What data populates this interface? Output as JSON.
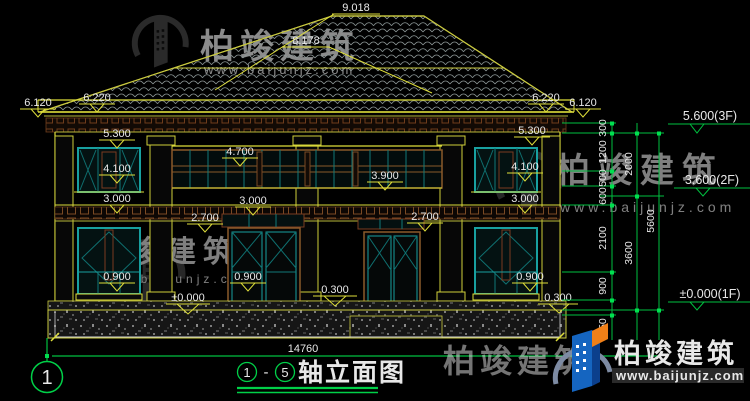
{
  "drawing": {
    "title_axis_start": "1",
    "title_axis_end": "5",
    "title_dash": "-",
    "title_text": "轴立面图",
    "axis_bubble_label": "1",
    "overall_dim": "14760"
  },
  "levels": {
    "ridge": "9.018",
    "sub_ridge": "8.178",
    "left_eave_outer": "6.120",
    "left_eave": "6.220",
    "left_53": "5.300",
    "left_41": "4.100",
    "left_30": "3.000",
    "left_09": "0.900",
    "right_eave": "6.220",
    "right_eave_outer": "6.120",
    "right_53": "5.300",
    "right_41": "4.100",
    "right_30": "3.000",
    "right_09": "0.900",
    "right_03": "0.300",
    "center_47": "4.700",
    "center_39": "3.900",
    "center_30": "3.000",
    "center_27_left": "2.700",
    "center_27_right": "2.700",
    "center_09": "0.900",
    "center_zero": "±0.000",
    "center_03": "0.300"
  },
  "right_chains": {
    "inner": [
      "300",
      "1200",
      "500",
      "600",
      "2100",
      "900",
      "450"
    ],
    "mid": [
      "2000",
      "3600"
    ],
    "outer": [
      "5600"
    ]
  },
  "floor_levels": {
    "f3": "5.600(3F)",
    "f2": "3.600(2F)",
    "f1": "±0.000(1F)"
  },
  "watermark": {
    "brand": "柏竣建筑",
    "url": "www.baijunjz.com"
  },
  "colors": {
    "line_yellow": "#dede3a",
    "line_green": "#00d048",
    "window_teal": "#18a0a0",
    "frame_brown": "#7a3b20",
    "logo_blue": "#1565c0",
    "logo_orange": "#f08018"
  }
}
